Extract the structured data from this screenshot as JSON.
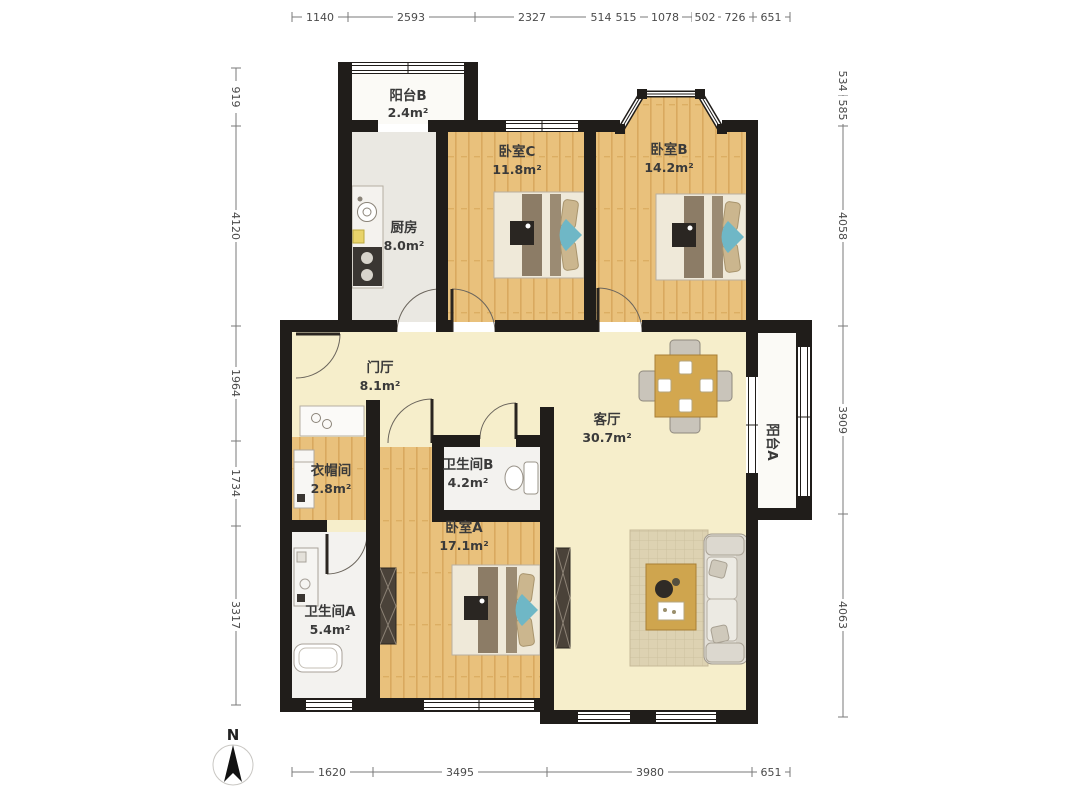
{
  "rooms": [
    {
      "id": "balcony-b",
      "name": "阳台B",
      "area": "2.4m²"
    },
    {
      "id": "kitchen",
      "name": "厨房",
      "area": "8.0m²"
    },
    {
      "id": "bedroom-c",
      "name": "卧室C",
      "area": "11.8m²"
    },
    {
      "id": "bedroom-b",
      "name": "卧室B",
      "area": "14.2m²"
    },
    {
      "id": "foyer",
      "name": "门厅",
      "area": "8.1m²"
    },
    {
      "id": "living-room",
      "name": "客厅",
      "area": "30.7m²"
    },
    {
      "id": "balcony-a",
      "name": "阳台A",
      "area": ""
    },
    {
      "id": "cloakroom",
      "name": "衣帽间",
      "area": "2.8m²"
    },
    {
      "id": "bathroom-b",
      "name": "卫生间B",
      "area": "4.2m²"
    },
    {
      "id": "bedroom-a",
      "name": "卧室A",
      "area": "17.1m²"
    },
    {
      "id": "bathroom-a",
      "name": "卫生间A",
      "area": "5.4m²"
    }
  ],
  "dimensions": {
    "top": [
      "1140",
      "2593",
      "2327",
      "514",
      "515",
      "1078",
      "502",
      "726",
      "651"
    ],
    "bottom": [
      "1620",
      "3495",
      "3980",
      "651"
    ],
    "left": [
      "919",
      "4120",
      "1964",
      "1734",
      "3317"
    ],
    "right": [
      "534",
      "585",
      "4058",
      "3909",
      "4063"
    ]
  },
  "compass": {
    "north_label": "N"
  },
  "colors": {
    "wall": "#201d1a",
    "wood_floor": "#e9c17c",
    "wood_stripe": "#d9a95f",
    "living_floor": "#f6eecb",
    "kitchen_floor": "#eae8e2",
    "bath_floor": "#f3f2ef",
    "balcony_floor": "#fbfaf6",
    "bed_accent_blue": "#6fb7c6",
    "table_wood": "#d3a74f",
    "dim_text": "#4a4a4a"
  }
}
